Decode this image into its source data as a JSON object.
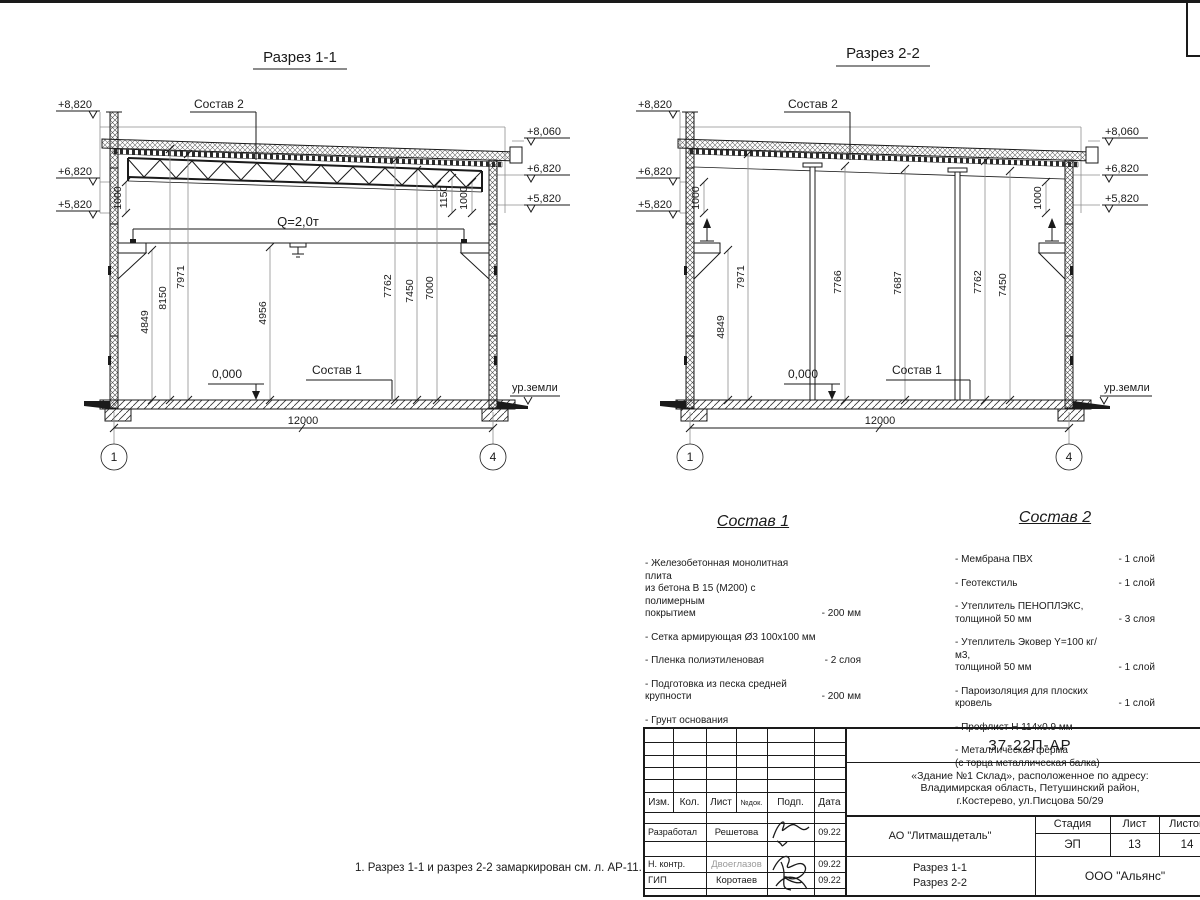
{
  "sections": {
    "s11": {
      "title": "Разрез 1-1",
      "marks_left": [
        "+8,820",
        "+6,820",
        "+5,820"
      ],
      "marks_right": [
        "+8,060",
        "+6,820",
        "+5,820"
      ],
      "label_sostav2": "Состав 2",
      "label_sostav1": "Состав 1",
      "zero_level": "0,000",
      "ground_level": "ур.земли",
      "crane_capacity": "Q=2,0т",
      "dim_1000_left": "1000",
      "dim_1150_right": "1150",
      "dim_1000_right": "1000",
      "dims": [
        "4849",
        "8150",
        "7971",
        "4956",
        "7762",
        "7450",
        "7000"
      ],
      "overall_width": "12000",
      "axis_left": "1",
      "axis_right": "4"
    },
    "s22": {
      "title": "Разрез 2-2",
      "marks_left": [
        "+8,820",
        "+6,820",
        "+5,820"
      ],
      "marks_right": [
        "+8,060",
        "+6,820",
        "+5,820"
      ],
      "label_sostav2": "Состав 2",
      "label_sostav1": "Состав 1",
      "zero_level": "0,000",
      "ground_level": "ур.земли",
      "dim_1000_left": "1000",
      "dim_1000_right": "1000",
      "dims": [
        "4849",
        "7971",
        "7766",
        "7687",
        "7762",
        "7450"
      ],
      "overall_width": "12000",
      "axis_left": "1",
      "axis_right": "4"
    }
  },
  "sostav1": {
    "title": "Состав 1",
    "items": [
      {
        "text": "- Железобетонная  монолитная плита\nиз бетона В 15 (М200) с полимерным\nпокрытием",
        "value": "- 200 мм"
      },
      {
        "text": "- Сетка армирующая Ø3 100х100 мм",
        "value": ""
      },
      {
        "text": "- Пленка полиэтиленовая",
        "value": "-  2 слоя"
      },
      {
        "text": "- Подготовка из песка средней\n  крупности",
        "value": "- 200 мм"
      },
      {
        "text": "- Грунт основания",
        "value": ""
      }
    ]
  },
  "sostav2": {
    "title": "Состав 2",
    "items": [
      {
        "text": "- Мембрана ПВХ",
        "value": "- 1 слой"
      },
      {
        "text": "- Геотекстиль",
        "value": "- 1 слой"
      },
      {
        "text": "- Утеплитель ПЕНОПЛЭКС,\n  толщиной 50 мм",
        "value": "- 3 слоя"
      },
      {
        "text": "- Утеплитель Эковер Y=100 кг/м3,\n  толщиной 50 мм",
        "value": "- 1 слой"
      },
      {
        "text": "- Пароизоляция для плоских кровель",
        "value": "- 1 слой"
      },
      {
        "text": "- Профлист Н 114х0.9 мм",
        "value": ""
      },
      {
        "text": "- Металлическая ферма\n(с торца металлическая балка)",
        "value": ""
      }
    ]
  },
  "note": "1. Разрез 1-1 и разрез 2-2 замаркирован см. л. АР-11.",
  "titleblock": {
    "doc_number": "37-22П-АР",
    "object": "«Здание №1 Склад», расположенное по адресу:\nВладимирская область, Петушинский район,\nг.Костерево, ул.Писцова 50/29",
    "header": {
      "izm": "Изм.",
      "kol": "Кол.",
      "list": "Лист",
      "ndok": "№док.",
      "podp": "Подп.",
      "data": "Дата"
    },
    "rows": [
      {
        "role": "Разработал",
        "name": "Решетова",
        "date": "09.22"
      },
      {
        "role": "Н. контр.",
        "name": "Двоеглазов",
        "date": "09.22"
      },
      {
        "role": "ГИП",
        "name": "Коротаев",
        "date": "09.22"
      }
    ],
    "company": "АО \"Литмашдеталь\"",
    "stage_label": "Стадия",
    "sheet_label": "Лист",
    "sheets_label": "Листов",
    "stage": "ЭП",
    "sheet": "13",
    "sheets": "14",
    "drawing_name": "Разрез 1-1\nРазрез 2-2",
    "org": "ООО \"Альянс\""
  }
}
